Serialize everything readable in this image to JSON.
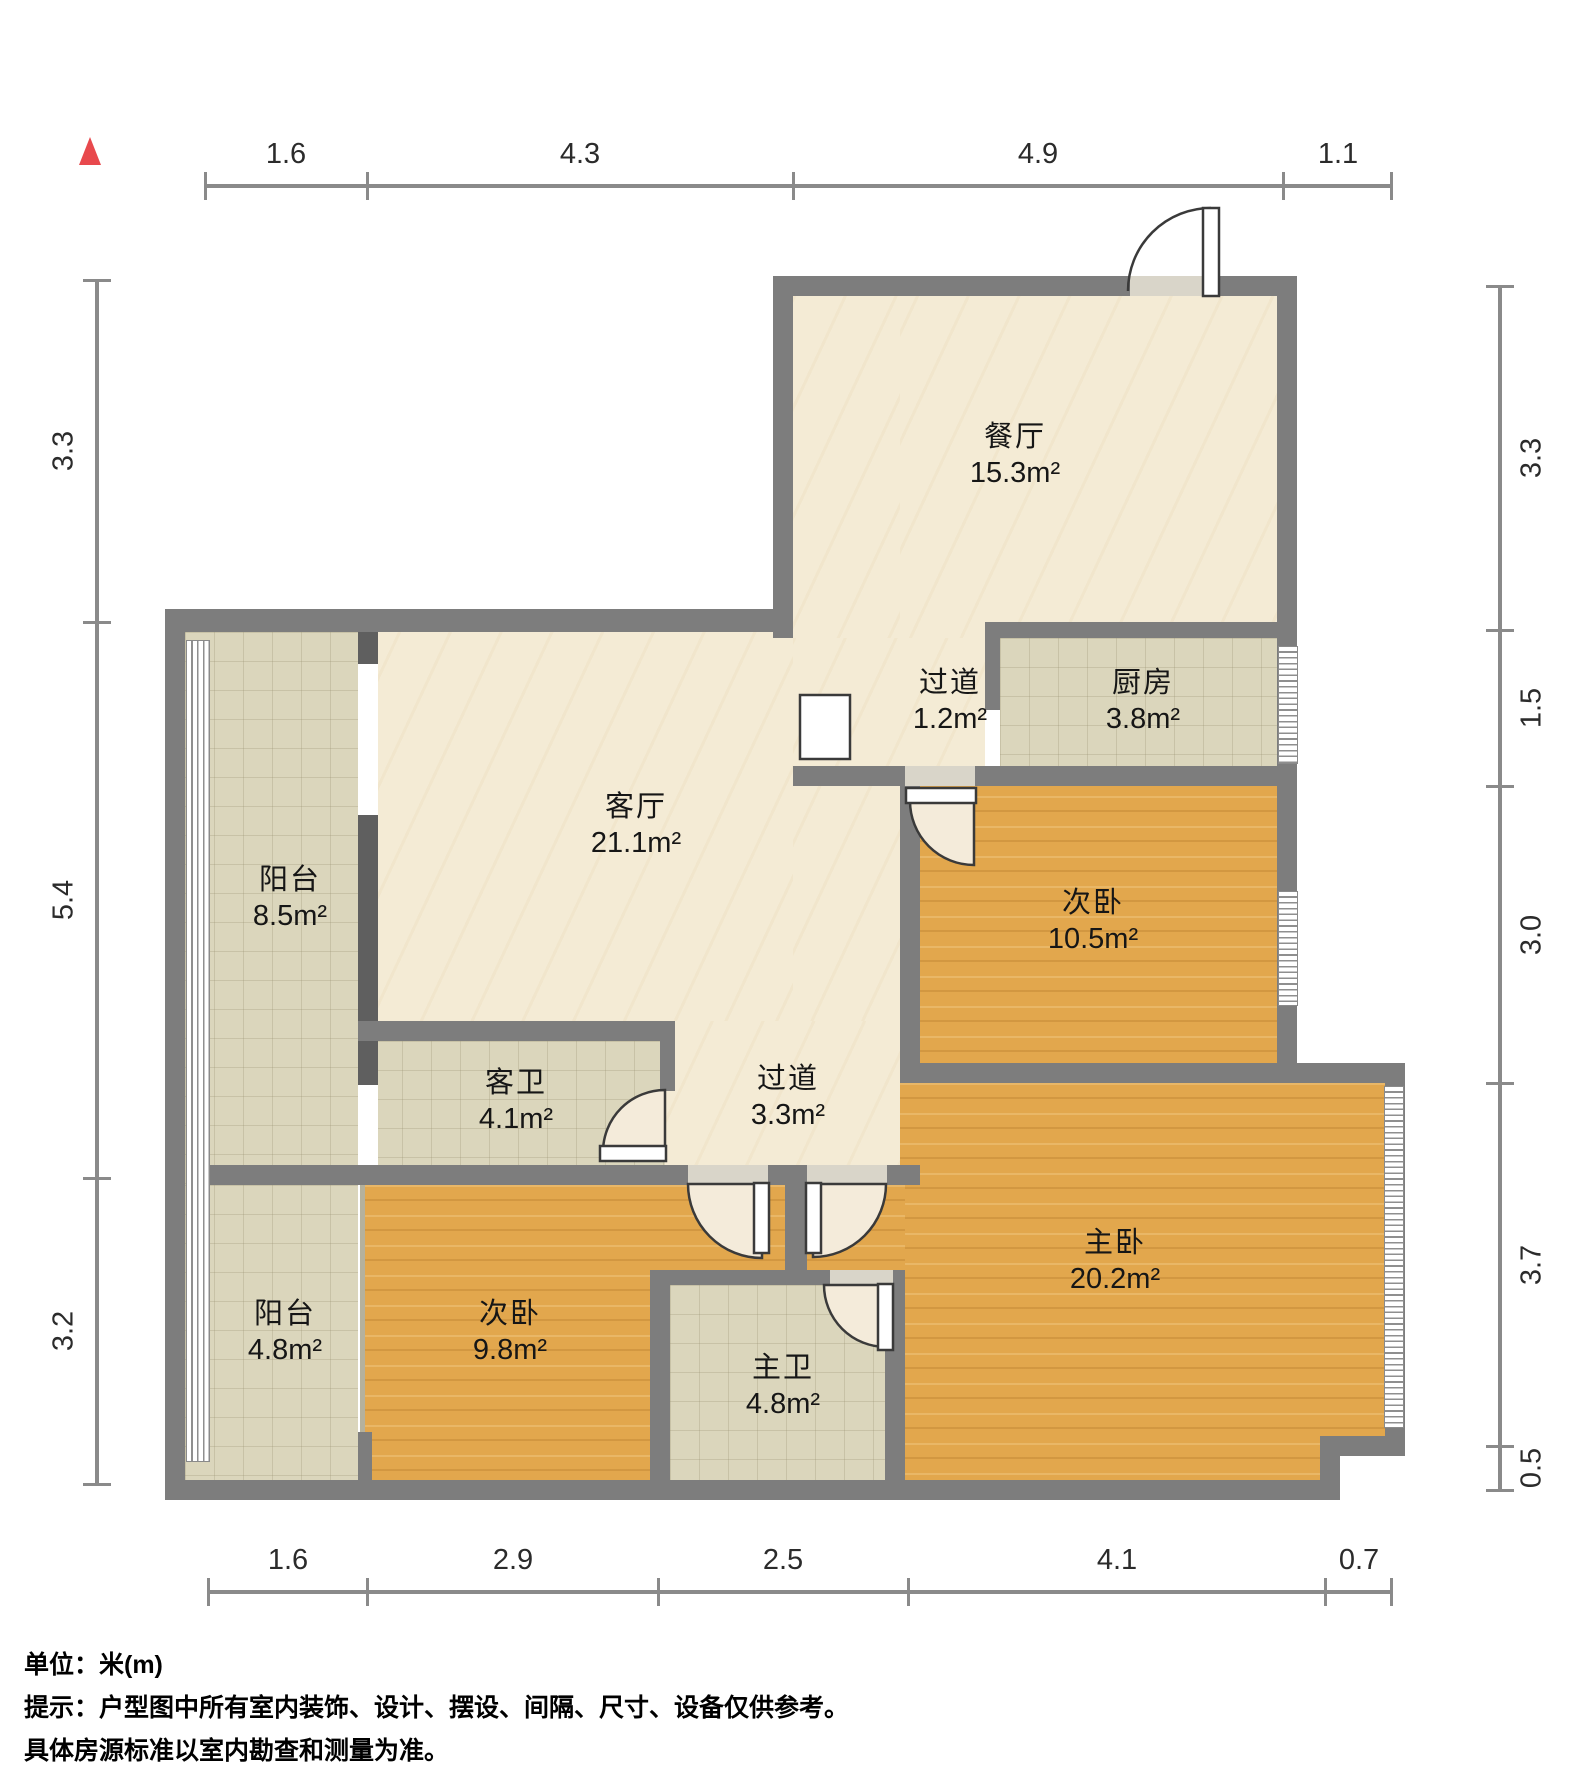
{
  "rooms": [
    {
      "id": "dining",
      "name": "餐厅",
      "area": "15.3m²"
    },
    {
      "id": "hallway-small",
      "name": "过道",
      "area": "1.2m²"
    },
    {
      "id": "kitchen",
      "name": "厨房",
      "area": "3.8m²"
    },
    {
      "id": "living",
      "name": "客厅",
      "area": "21.1m²"
    },
    {
      "id": "balcony-north",
      "name": "阳台",
      "area": "8.5m²"
    },
    {
      "id": "bedroom-2",
      "name": "次卧",
      "area": "10.5m²"
    },
    {
      "id": "guest-bath",
      "name": "客卫",
      "area": "4.1m²"
    },
    {
      "id": "hallway",
      "name": "过道",
      "area": "3.3m²"
    },
    {
      "id": "master-bedroom",
      "name": "主卧",
      "area": "20.2m²"
    },
    {
      "id": "balcony-south",
      "name": "阳台",
      "area": "4.8m²"
    },
    {
      "id": "bedroom-3",
      "name": "次卧",
      "area": "9.8m²"
    },
    {
      "id": "master-bath",
      "name": "主卫",
      "area": "4.8m²"
    }
  ],
  "dimensions": {
    "top": [
      "1.6",
      "4.3",
      "4.9",
      "1.1"
    ],
    "bottom": [
      "1.6",
      "2.9",
      "2.5",
      "4.1",
      "0.7"
    ],
    "left": [
      "3.3",
      "5.4",
      "3.2"
    ],
    "right": [
      "3.3",
      "1.5",
      "3.0",
      "3.7",
      "0.5"
    ]
  },
  "notes": [
    "单位：米(m)",
    "提示：户型图中所有室内装饰、设计、摆设、间隔、尺寸、设备仅供参考。",
    "具体房源标准以室内勘查和测量为准。"
  ],
  "colors": {
    "wall": "#7d7d7d",
    "marble_floor": "#f4ebd5",
    "tile_floor": "#dbd6bc",
    "wood_floor": "#e2a74d",
    "north_marker": "#e8494d"
  }
}
